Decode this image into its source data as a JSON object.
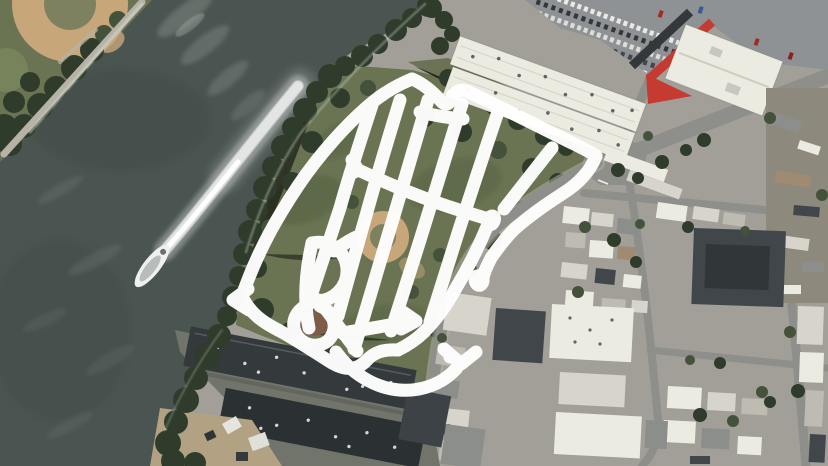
{
  "scene": {
    "description": "Aerial satellite photograph of a riverside park peninsula with a thick white hand-drawn route scribble over the park, a river with a boat and long wake to the west, warehouses with a red-roofed building and a car-filled parking lot to the northeast, dense city blocks to the east, and dark industrial rooftops along the southern waterfront",
    "image_type": "satellite-aerial-photo",
    "width": 828,
    "height": 466,
    "visible_text": "none"
  },
  "palette": {
    "water": "#4a5450",
    "water-dark": "#3e4845",
    "foam": "#d8ddd6",
    "grass": "#6a7452",
    "grass-light": "#8e9268",
    "tree-dark": "#2f3c2b",
    "tree": "#44523b",
    "sand": "#c7a67a",
    "infield": "#7e8160",
    "road-light": "#b6b3a6",
    "street": "#8e8f8a",
    "city-base": "#a19f98",
    "roof-white": "#ecebe2",
    "roof-light": "#d7d5cb",
    "roof-mid": "#bdbbb2",
    "roof-gray": "#8b8e8a",
    "roof-dark": "#40464a",
    "roof-darker": "#313639",
    "roof-brown": "#9f8a72",
    "red": "#c53a31",
    "industrial-ground": "#71746b",
    "industrial-dark": "#34393c",
    "industrial-darker": "#2b3033",
    "dirt": "#b2a183",
    "yard": "#8d897d",
    "scrub": "#6c7354",
    "annotation": "#ffffff"
  },
  "annotation": {
    "name": "hand-drawn-route-scribble",
    "color": "#ffffff",
    "stroke_width": 13,
    "opacity": 0.97,
    "paths": [
      {
        "name": "nw-edge",
        "d": "M242,296 C258,250 278,216 298,186 C318,156 348,122 374,101 C388,90 402,83 412,79"
      },
      {
        "name": "top-edge",
        "d": "M412,79 C424,84 433,92 441,101 C446,107 450,104 452,97 C456,90 463,88 471,93 C500,107 540,127 566,140 C578,146 589,151 596,156"
      },
      {
        "name": "right-edge",
        "d": "M596,156 C590,172 578,184 562,194 C548,203 532,214 518,226 C508,234 498,248 491,258 C487,266 484,272 483,278"
      },
      {
        "name": "right-edge-end-loop",
        "d": "M483,278 C478,273 473,277 476,283 C479,288 484,284 483,278"
      },
      {
        "name": "middle-line",
        "d": "M354,168 C386,183 424,199 456,209 C468,213 479,216 488,219"
      },
      {
        "name": "middle-line-end-loop",
        "d": "M488,219 C492,213 497,217 493,223 C490,227 486,224 488,219"
      },
      {
        "name": "se-edge",
        "d": "M489,222 C480,244 468,268 456,288 C445,308 434,322 424,332 C416,340 406,346 398,350"
      },
      {
        "name": "bottom-edge",
        "d": "M242,296 C250,314 264,323 280,331 C298,341 316,353 332,363 C346,371 357,370 366,361 C374,352 384,349 398,350"
      },
      {
        "name": "bottom-swoosh",
        "d": "M336,352 C350,372 374,388 399,390 C424,392 444,382 456,369 C460,364 457,357 450,357"
      },
      {
        "name": "bottom-arrow",
        "d": "M444,349 L461,364 L476,352"
      },
      {
        "name": "stripe-1",
        "d": "M372,105 C362,136 350,172 340,208 C331,236 321,266 311,296"
      },
      {
        "name": "stripe-2",
        "d": "M400,100 C389,136 378,172 367,212 C357,247 347,283 338,316"
      },
      {
        "name": "stripe-3",
        "d": "M428,100 C417,138 405,178 393,219 C381,258 368,304 354,349"
      },
      {
        "name": "stripe-4",
        "d": "M462,104 C450,142 438,182 425,224 C413,263 401,300 391,331"
      },
      {
        "name": "stripe-5",
        "d": "M498,112 C485,150 472,190 459,230 C449,261 439,294 430,322"
      },
      {
        "name": "stripe-6",
        "d": "M552,148 C536,168 519,190 504,209"
      },
      {
        "name": "top-link",
        "d": "M420,112 C436,116 450,118 463,119"
      },
      {
        "name": "r-stem",
        "d": "M312,243 C306,270 303,300 309,328"
      },
      {
        "name": "r-loop",
        "d": "M312,243 C330,239 346,251 347,269 C348,287 334,300 318,301"
      },
      {
        "name": "r-ring",
        "d": "M308,305 C295,310 289,325 298,337 C307,348 324,348 331,337 C338,326 333,311 320,306"
      },
      {
        "name": "r-leg",
        "d": "M319,300 C332,318 345,335 357,351"
      },
      {
        "name": "r-top",
        "d": "M334,251 C342,245 351,239 359,236"
      },
      {
        "name": "lower-mid-line",
        "d": "M342,333 C367,329 391,325 411,321"
      },
      {
        "name": "lower-mid-arrow",
        "d": "M403,312 L416,321 L401,329"
      },
      {
        "name": "bottom-left-hook",
        "d": "M248,289 L233,300 L249,310"
      },
      {
        "name": "middle-start-kink",
        "d": "M352,160 L358,170 L350,174"
      }
    ]
  },
  "boat": {
    "x": 152,
    "y": 266,
    "rotation": -52,
    "wake_path": "M165,250 C205,204 248,146 298,86"
  },
  "features": [
    "river",
    "boat",
    "boat-wake",
    "riverside-park",
    "baseball-diamond",
    "park-trees",
    "warehouse-roofs",
    "parking-lot",
    "red-roof-building",
    "main-intersection",
    "city-blocks",
    "industrial-rooftops",
    "shoreline-trees",
    "corner-ballfield-park"
  ]
}
